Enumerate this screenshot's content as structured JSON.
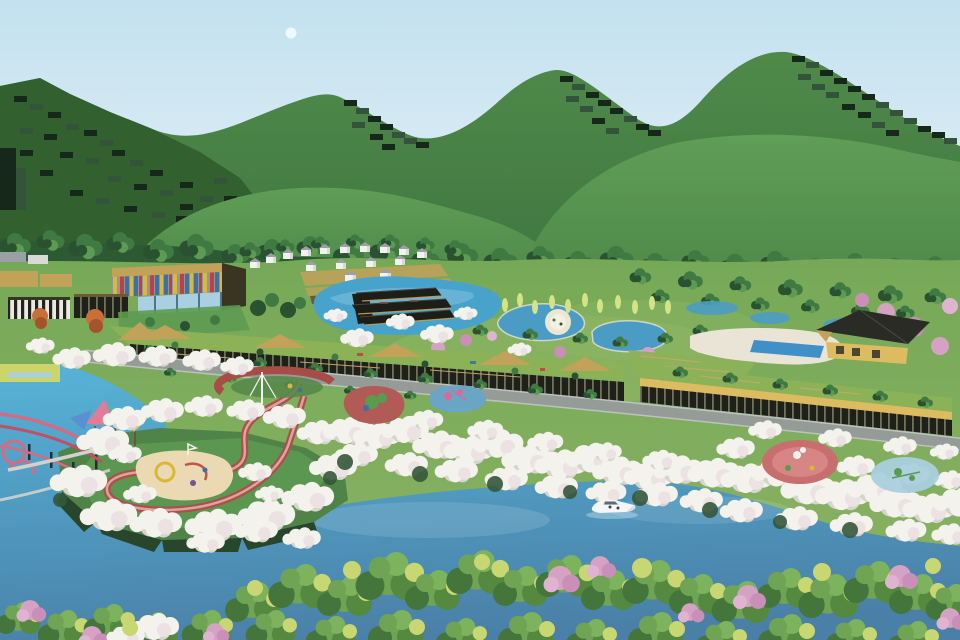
{
  "scene": {
    "type": "3d-aerial-masterplan-rendering",
    "subject": "Bird's-eye architectural rendering of a riverside resort park: voxel-stepped green mountains, forest band, striped cultural center, white villa cluster, black-roof pavilion on a lake, garden ponds with a round island, terraced green-roof buildings with dark colonnades, a grey road, cherry-blossom tree bands with playground pockets, a red loop walkway, pink footbridges, a turquoise river with a white motorboat and dense foreground trees",
    "objects": [
      "sky",
      "moon",
      "voxel-mountains",
      "forest-band",
      "striped-cultural-center",
      "zebra-annex",
      "villa-cluster",
      "black-roof-pavilion",
      "lake",
      "garden-ponds",
      "round-island",
      "right-villa",
      "swimming-pool",
      "terraced-green-roof-buildings",
      "main-road",
      "cherry-blossom-bands",
      "red-loop-walkway",
      "sand-playground",
      "red-bowl-playground",
      "playground-pockets",
      "pink-footbridges",
      "canopy-pavilion",
      "river",
      "motorboat",
      "foreground-trees"
    ]
  },
  "palette": {
    "sky_top": "#c3e1ef",
    "sky_bottom": "#e9f3f8",
    "moon": "#f6fbfd",
    "mtn_top": "#4f8a49",
    "mtn_bottom": "#3e7240",
    "left_hill": "#33602f",
    "step_dark": "#16281a",
    "step_mid": "#33543a",
    "hill_top": "#5f9e57",
    "hill_bottom": "#4c8647",
    "forest": "#2e5a33",
    "tree": "#3f7a42",
    "tree_dark": "#2a5130",
    "tree_light": "#5d9b52",
    "terrain_top": "#76a957",
    "terrain_bottom": "#8bb364",
    "meadow": "#8fb765",
    "tan": "#c2a159",
    "tan_dark": "#6b5b35",
    "wall_dark": "#3a3423",
    "zebra_light": "#e9e9e2",
    "zebra_dark": "#23231d",
    "stripe_red": "#bf4040",
    "stripe_blue": "#3e6fa8",
    "stripe_yellow": "#d8b83e",
    "stripe_grey": "#8e979c",
    "glass": "#a9cfe1",
    "mullion": "#4f758d",
    "house_white": "#f2f2ee",
    "house_roof": "#9aa0a6",
    "house_side": "#d9dad6",
    "pavilion": "#1e1e19",
    "pavilion_hi": "#45453c",
    "lake": "#47a3cc",
    "pond": "#4b9cc4",
    "island": "#ece7d5",
    "island_core": "#f4f0e2",
    "deck": "#e9e4d6",
    "pool": "#3f8fc9",
    "roof_green": "#8cb258",
    "pillar_bg": "#1f201a",
    "pillar_light": "#6e725a",
    "yellow_wall": "#ddbb60",
    "roof_dark": "#2b2b26",
    "road": "#959b97",
    "road_edge": "#bcc2bd",
    "fence": "#c8a86a",
    "blossom": "#f3f2ed",
    "blossom_shade": "#d6d5cc",
    "blossom_pink": "#ece2e4",
    "under_green": "#35573a",
    "path_red": "#ad4f4b",
    "path_red_hi": "#dca49e",
    "sand": "#ead9b2",
    "play_red": "#b25a56",
    "play_blue": "#6aa6c4",
    "play_green": "#5a9b4e",
    "play_pink": "#d86a9a",
    "pg_red": "#c86e6e",
    "pg_red_hi": "#d88585",
    "pg_blue": "#a9cfdd",
    "bridge_pink": "#d46a84",
    "bridge_red": "#c24f62",
    "boardwalk": "#ced3cf",
    "pier": "#1e2f39",
    "canopy_pink": "#e27a9a",
    "canopy_teal": "#4fb6b0",
    "canopy_yellow": "#e6c74f",
    "canopy_blue": "#5a8fd0",
    "water_top": "#56b1d6",
    "water_bottom": "#4a80a7",
    "pen": "#4f8347",
    "pen_dark": "#27462b",
    "pen_bright": "#5d9b52",
    "boat": "#f4f6f8",
    "boat_side": "#d8dde0",
    "boat_cabin": "#e8edf0",
    "boat_glass": "#46525a",
    "wake": "#cfe9f4",
    "fg_green": "#6fa455",
    "fg_green2": "#55893f",
    "fg_dark": "#44753a",
    "fg_green3": "#7cb35c",
    "fg_yellow": "#c9d773",
    "pink_tree": "#d5a2c4",
    "pink_tree2": "#c98fb8",
    "pink_tree3": "#e0b3d2",
    "poplar": "#d4e288",
    "orange_tree": "#c96f3a",
    "orange_dark": "#a5532a",
    "ylg": "#ccd668",
    "mast_white": "#f4f4f0",
    "bowl_red": "#a84c48",
    "bowl_green": "#56884a"
  }
}
